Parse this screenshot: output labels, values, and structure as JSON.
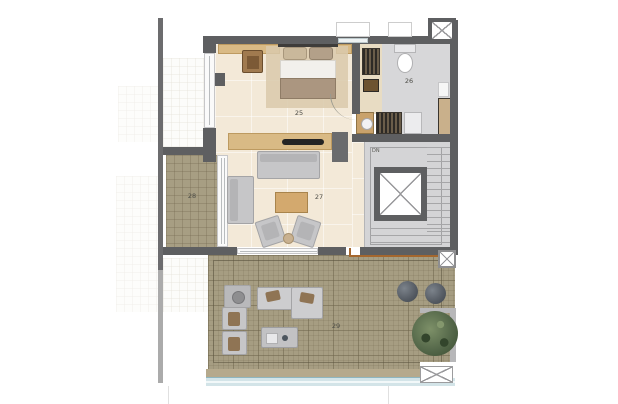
{
  "rooms": {
    "bedroom": {
      "label": "25"
    },
    "bathroom": {
      "label": "26"
    },
    "living_room": {
      "label": "27"
    },
    "balcony": {
      "label": "28"
    },
    "terrace": {
      "label": "29"
    }
  },
  "stairs": {
    "down_label": "DN"
  },
  "palette": {
    "wall": "#5e5f61",
    "floor_interior": "#f3e9d8",
    "floor_wet_areas": "#d7d7d9",
    "floor_deck": "#a79e83",
    "wood_furniture": "#d9ba85",
    "upholstery": "#c6c6c8",
    "glass_railing": "#d3e4e8",
    "boundary_line": "#a5672e",
    "tree": "#4d6142"
  }
}
